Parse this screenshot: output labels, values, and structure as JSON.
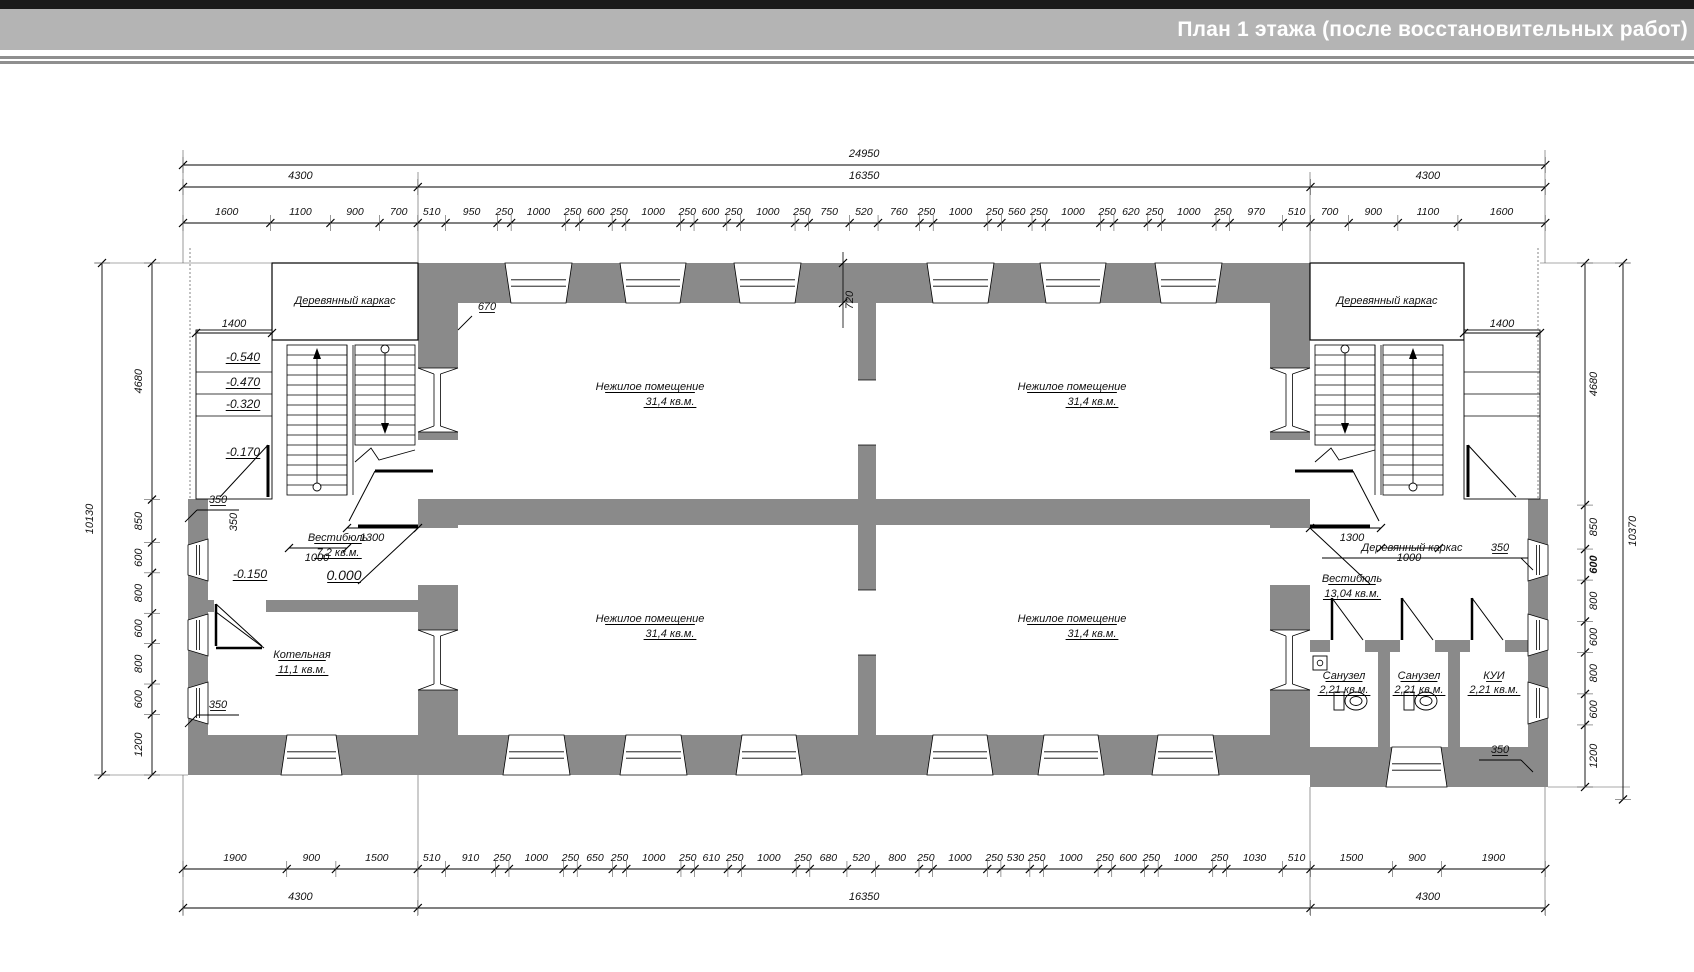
{
  "title_bar": {
    "title": "План 1 этажа (после восстановительных работ)"
  },
  "plan": {
    "rooms": {
      "nonresidential": {
        "name": "Нежилое помещение",
        "area": "31,4 кв.м."
      },
      "vestibule_left": {
        "name": "Вестибюль",
        "area": "7,2 кв.м."
      },
      "vestibule_right": {
        "name": "Вестибюль",
        "area": "13,04 кв.м."
      },
      "boiler": {
        "name": "Котельная",
        "area": "11,1 кв.м."
      },
      "wc": {
        "name": "Санузел",
        "area": "2,21 кв.м."
      },
      "storage": {
        "name": "КУИ",
        "area": "2,21 кв.м."
      },
      "wood_frame": "Деревянный каркас"
    },
    "elevations": {
      "e540": "-0.540",
      "e470": "-0.470",
      "e320": "-0.320",
      "e170": "-0.170",
      "e150": "-0.150",
      "zero": "0.000"
    },
    "dimensions": {
      "top_total": "24950",
      "axes": [
        "4300",
        "16350",
        "4300"
      ],
      "top_detail": [
        "1600",
        "1100",
        "900",
        "700",
        "510",
        "950",
        "250",
        "1000",
        "250",
        "600",
        "250",
        "1000",
        "250",
        "600",
        "250",
        "1000",
        "250",
        "750",
        "520",
        "760",
        "250",
        "1000",
        "250",
        "560",
        "250",
        "1000",
        "250",
        "620",
        "250",
        "1000",
        "250",
        "970",
        "510",
        "700",
        "900",
        "1100",
        "1600"
      ],
      "bottom_detail": [
        "1900",
        "900",
        "1500",
        "510",
        "910",
        "250",
        "1000",
        "250",
        "650",
        "250",
        "1000",
        "250",
        "610",
        "250",
        "1000",
        "250",
        "680",
        "520",
        "800",
        "250",
        "1000",
        "250",
        "530",
        "250",
        "1000",
        "250",
        "600",
        "250",
        "1000",
        "250",
        "1030",
        "510",
        "1500",
        "900",
        "1900"
      ],
      "side_detail": [
        "4680",
        "850",
        "600",
        "800",
        "600",
        "800",
        "600",
        "1200"
      ],
      "left_total": "10130",
      "right_total": "10370",
      "stair_width": "1000",
      "landing_width": "1300",
      "porch_width": "1400",
      "wall_offset": "350",
      "pier_offset_left": "670",
      "pier_offset_center": "720"
    }
  }
}
